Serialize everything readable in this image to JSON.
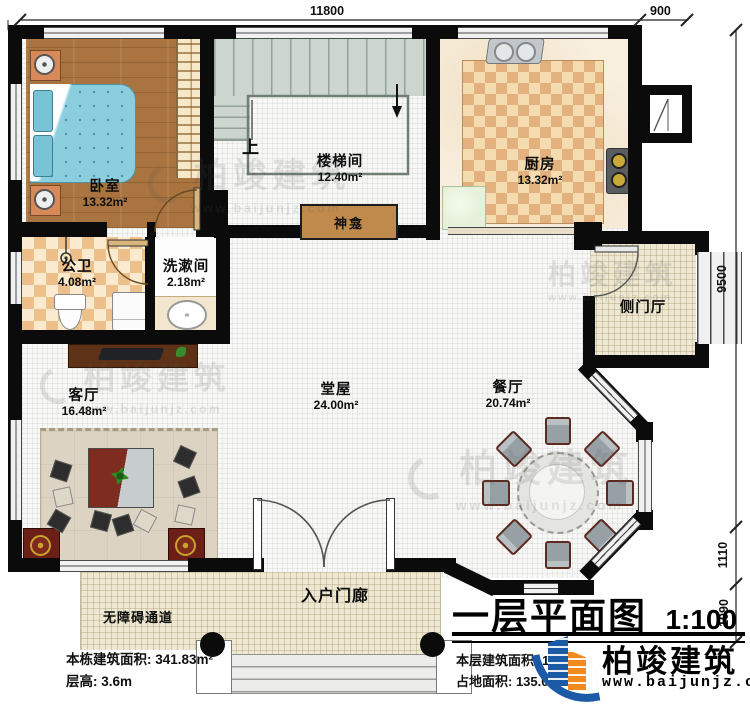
{
  "dims": {
    "top": "11800",
    "top_right": "900",
    "right_upper": "9500",
    "right_mid": "1110",
    "right_lower": "1090"
  },
  "rooms": {
    "bedroom": {
      "name": "卧室",
      "area": "13.32m²"
    },
    "stairwell": {
      "name": "楼梯间",
      "area": "12.40m²"
    },
    "kitchen": {
      "name": "厨房",
      "area": "13.32m²"
    },
    "bathroom": {
      "name": "公卫",
      "area": "4.08m²"
    },
    "washroom": {
      "name": "洗漱间",
      "area": "2.18m²"
    },
    "living": {
      "name": "客厅",
      "area": "16.48m²"
    },
    "hall": {
      "name": "堂屋",
      "area": "24.00m²"
    },
    "dining": {
      "name": "餐厅",
      "area": "20.74m²"
    },
    "side_hall": {
      "name": "侧门厅"
    },
    "porch": {
      "name": "入户门廊"
    },
    "ramp": {
      "name": "无障碍通道"
    }
  },
  "annotations": {
    "up": "上",
    "shrine": "神龛"
  },
  "title": {
    "text": "一层平面图",
    "scale": "1:100"
  },
  "info_left": {
    "line1": "本栋建筑面积: 341.83m²",
    "line2": "层高: 3.6m"
  },
  "info_right": {
    "line1": "本层建筑面积: 12",
    "line2": "占地面积: 135.0"
  },
  "brand": {
    "name": "柏竣建筑",
    "website": "www.baijunjz.com"
  },
  "watermark": {
    "text": "柏竣建筑",
    "sub": "www.baijunjz.com"
  },
  "colors": {
    "wall": "#0b0b0b",
    "logo_blue": "#1b5aa5",
    "logo_orange": "#f28a1d",
    "accent_maroon": "#6b1f16"
  }
}
